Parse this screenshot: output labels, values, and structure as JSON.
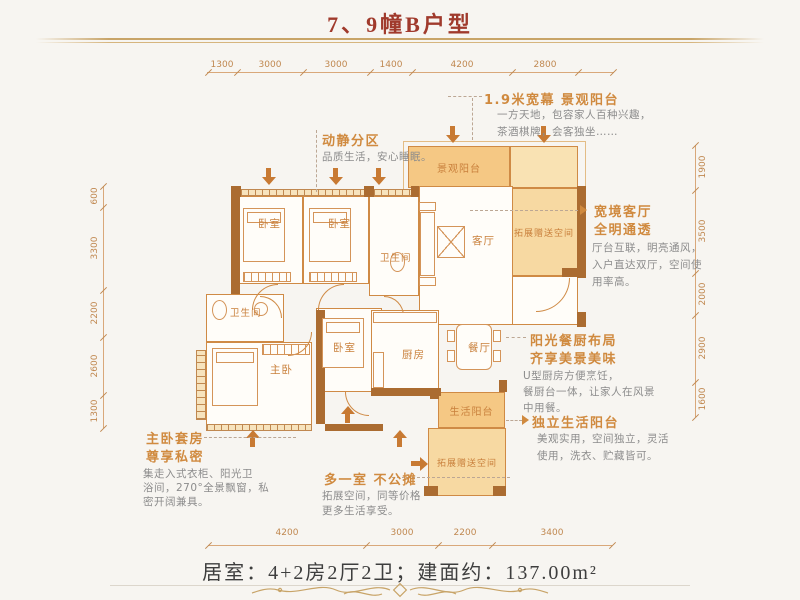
{
  "page": {
    "title": "7、9幢B户型",
    "summary": "居室：4+2房2厅2卫；建面约：137.00m²"
  },
  "colors": {
    "title_red": "#a03a2c",
    "gold_rule": "#c8a468",
    "plan_line_orange": "#cf8a45",
    "wall_brown": "#ab6c31",
    "balcony_fill": "#f5c884",
    "bonus_fill": "#f7d9a2",
    "annotation_orange": "#d08a3f",
    "body_gray": "#8c8c8c"
  },
  "dims": {
    "top": [
      "1300",
      "3000",
      "3000",
      "1400",
      "4200",
      "2800"
    ],
    "bottom": [
      "4200",
      "3000",
      "2200",
      "3400"
    ],
    "left": [
      "600",
      "3300",
      "2200",
      "2600",
      "1300"
    ],
    "right": [
      "1900",
      "3500",
      "2000",
      "2900",
      "1600"
    ]
  },
  "rooms": {
    "bedroom_a": "卧室",
    "bedroom_b": "卧室",
    "bath_a": "卫生间",
    "living": "客厅",
    "view_balcony": "景观阳台",
    "bonus_right": "拓展赠送空间",
    "bath_b": "卫生间",
    "master": "主卧",
    "bedroom_c": "卧室",
    "kitchen": "厨房",
    "dining": "餐厅",
    "life_balcony": "生活阳台",
    "bonus_bottom": "拓展赠送空间"
  },
  "annotations": {
    "balcony19": {
      "title": "1.9米宽幕 景观阳台",
      "line1": "一方天地，包容家人百种兴趣，",
      "line2": "茶酒棋牌，会客独坐……"
    },
    "zoning": {
      "title": "动静分区",
      "line1": "品质生活，安心睡眠。"
    },
    "living": {
      "title1": "宽境客厅",
      "title2": "全明通透",
      "line1": "厅台互联，明亮通风，",
      "line2": "入户直达双厅，空间使",
      "line3": "用率高。"
    },
    "kitchen": {
      "title1": "阳光餐厨布局",
      "title2": "齐享美景美味",
      "line1": "U型厨房方便烹饪，",
      "line2": "餐厨台一体，让家人在风景",
      "line3": "中用餐。"
    },
    "life_balcony": {
      "title": "独立生活阳台",
      "line1": "美观实用，空间独立，灵活",
      "line2": "使用，洗衣、贮藏皆可。"
    },
    "master": {
      "title1": "主卧套房",
      "title2": "尊享私密",
      "line1": "集走入式衣柜、阳光卫",
      "line2": "浴间，270°全景飘窗，私",
      "line3": "密开阔兼具。"
    },
    "bonus_room": {
      "title": "多一室 不公摊",
      "line1": "拓展空间，同等价格",
      "line2": "更多生活享受。"
    }
  }
}
